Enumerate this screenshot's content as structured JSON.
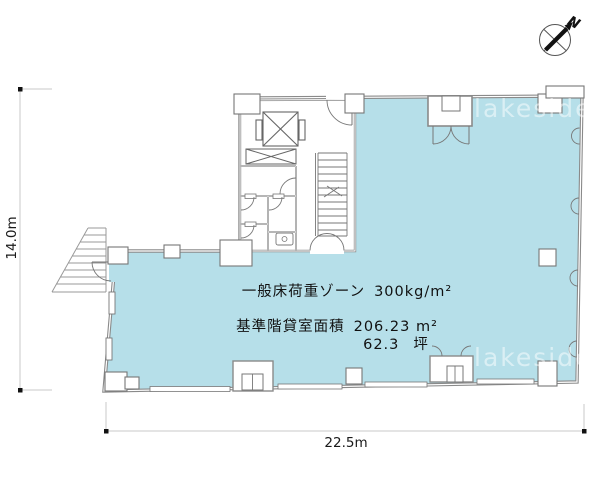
{
  "plan": {
    "annotations": {
      "floor_load": {
        "label": "一般床荷重ゾーン",
        "value": "300kg/m²"
      },
      "rental_area": {
        "label": "基準階貸室面積",
        "value": "206.23 m²"
      },
      "tsubo": {
        "value": "62.3",
        "unit": "坪"
      }
    },
    "colors": {
      "floor_fill": "#b6dfe9",
      "wall": "#8a8a8a"
    }
  },
  "dimensions": {
    "height": "14.0m",
    "width": "22.5m"
  },
  "compass": {
    "north_label": "N"
  },
  "watermark": {
    "text": "lakeside"
  }
}
